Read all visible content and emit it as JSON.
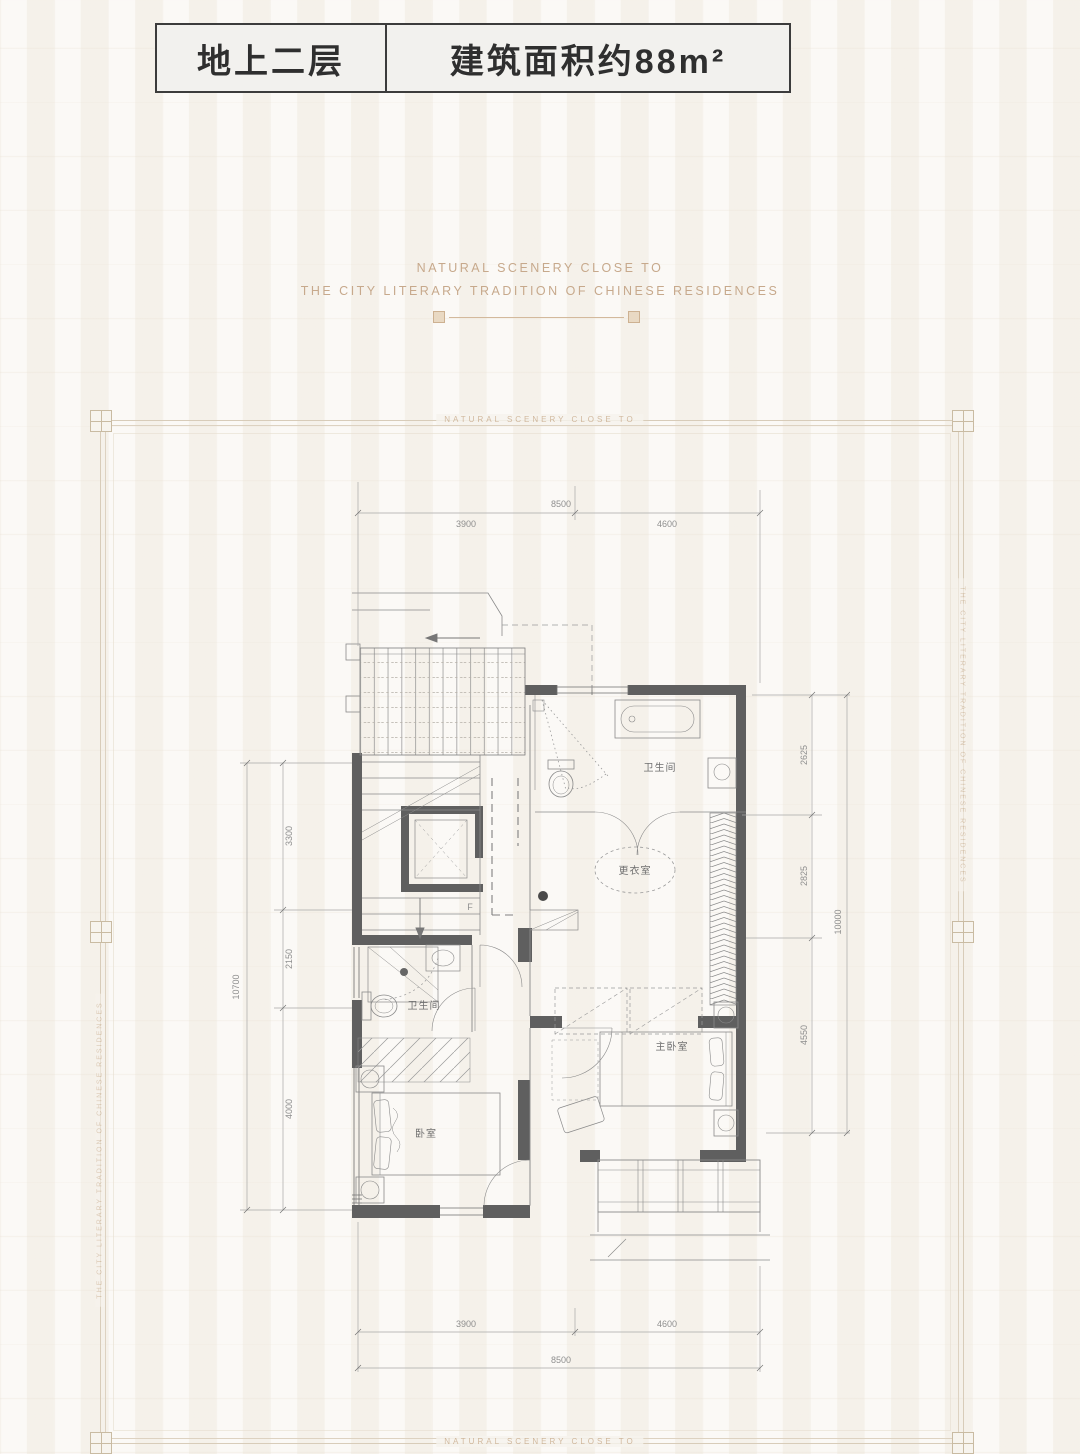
{
  "header": {
    "floor": "地上二层",
    "area": "建筑面积约88m²"
  },
  "tagline": {
    "line1": "NATURAL SCENERY CLOSE TO",
    "line2": "THE CITY LITERARY TRADITION OF CHINESE RESIDENCES"
  },
  "frame": {
    "top_text": "NATURAL SCENERY CLOSE TO",
    "bottom_text": "NATURAL SCENERY CLOSE TO",
    "left_text": "THE CITY LITERARY TRADITION OF CHINESE RESIDENCES",
    "right_text": "THE CITY LITERARY TRADITION OF CHINESE RESIDENCES",
    "accent_color": "#d8ccb9"
  },
  "plan": {
    "rooms": {
      "bath_main": "卫生间",
      "dressing": "更衣室",
      "master": "主卧室",
      "bath_second": "卫生间",
      "bedroom": "卧室"
    },
    "stair_label": "F",
    "dimensions": {
      "top": {
        "total": "8500",
        "segments": [
          "3900",
          "4600"
        ]
      },
      "bottom": {
        "total": "8500",
        "segments": [
          "3900",
          "4600"
        ]
      },
      "left": {
        "total": "10700",
        "segments": [
          "3300",
          "2150",
          "4000"
        ]
      },
      "right": {
        "total": "10000",
        "segments": [
          "2625",
          "2825",
          "4550"
        ]
      }
    }
  }
}
